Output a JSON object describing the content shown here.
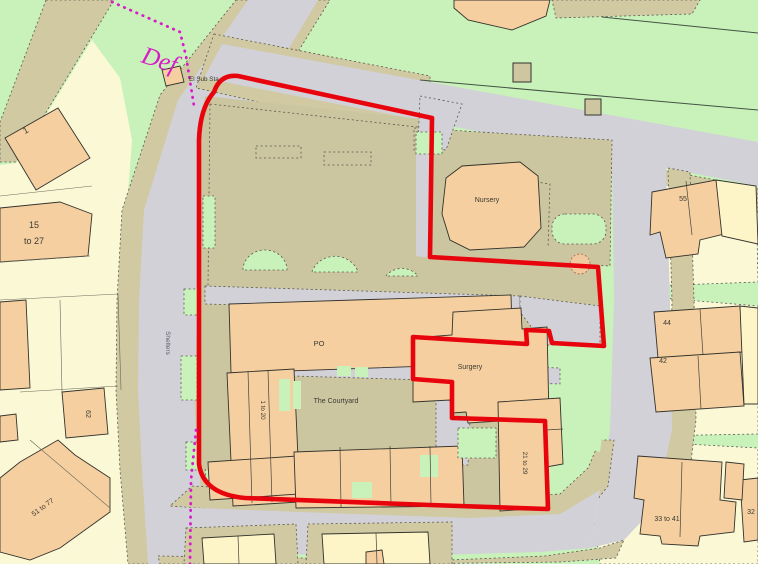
{
  "map": {
    "kind": "ordnance-survey-site-location-plan",
    "boundary": {
      "site_outline_color": "#e8040c",
      "parish_boundary_color": "#d81cc8",
      "parish_boundary_label": "Def"
    },
    "labels": {
      "el_sub_sta": "El Sub Sta",
      "nursery": "Nursery",
      "po": "PO",
      "surgery": "Surgery",
      "courtyard": "The Courtyard",
      "flats_1_20": "1 to 20",
      "flats_21_29": "21 to 29",
      "shelters": "Shelters",
      "house_1": "1",
      "houses_15_27_line1": "15",
      "houses_15_27_line2": "to 27",
      "house_62": "62",
      "houses_51_77": "51 to 77",
      "house_55": "55",
      "house_44": "44",
      "house_42": "42",
      "house_32": "32",
      "houses_33_41": "33 to 41"
    },
    "colors": {
      "grass": "#c9f2ba",
      "parcel": "#fbf8d6",
      "verge": "#d0c9a2",
      "site": "#ccc6a0",
      "road": "#d2d1d8",
      "building": "#f6cfa0",
      "building_pale": "#fdf4c8",
      "boundary_red": "#e8040c",
      "boundary_magenta": "#d81cc8",
      "outline": "#33332c"
    }
  }
}
